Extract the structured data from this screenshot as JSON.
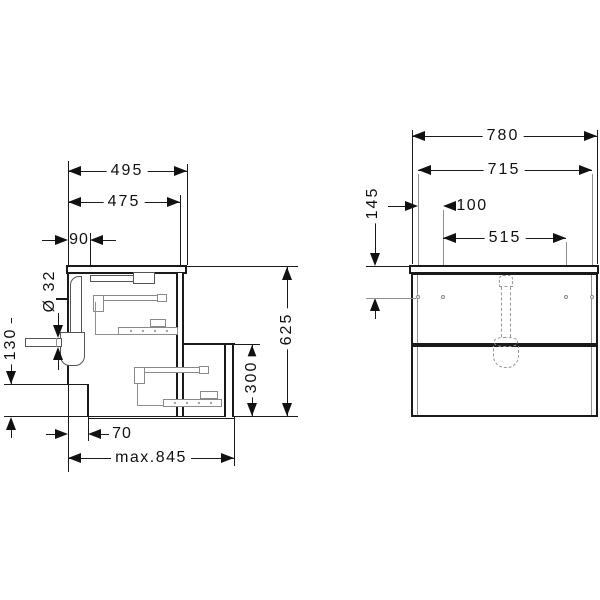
{
  "drawing": {
    "type": "technical-dimension-drawing",
    "subject": "wall-hung vanity unit with two drawers — side section (left) and front elevation (right)",
    "units": "mm",
    "line_color": "#1a1a1a",
    "detail_color": "#8a8a8a",
    "side_view": {
      "dims": {
        "width_with_top": "495",
        "body_depth": "475",
        "drain_offset": "90",
        "drain_diameter": "Ø 32",
        "recess_height": "130",
        "total_height": "625",
        "lower_drawer_height": "300",
        "recess_depth": "70",
        "max_extension": "max.845"
      }
    },
    "front_view": {
      "dims": {
        "total_width": "780",
        "mount_span_outer": "715",
        "hole_offset": "100",
        "mount_span_inner": "515",
        "top_to_holes": "145"
      }
    }
  }
}
